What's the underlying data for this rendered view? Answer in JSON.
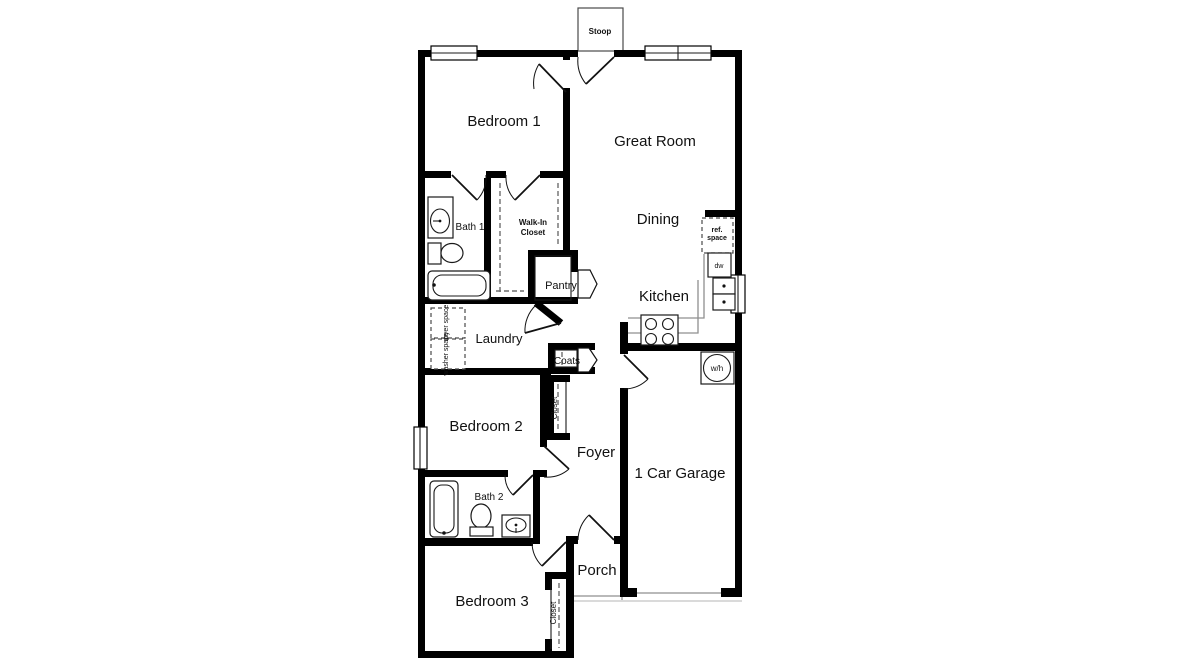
{
  "colors": {
    "wall": "#000000",
    "thin_line": "#8f8f8f",
    "background": "#ffffff",
    "text": "#111111"
  },
  "labels": {
    "stoop": "Stoop",
    "bedroom1": "Bedroom 1",
    "great_room": "Great Room",
    "dining": "Dining",
    "kitchen": "Kitchen",
    "bath1": "Bath 1",
    "walk_in_line1": "Walk-In",
    "walk_in_line2": "Closet",
    "pantry": "Pantry",
    "laundry": "Laundry",
    "coats": "Coats",
    "hall_closet": "Closet",
    "bedroom2": "Bedroom 2",
    "foyer": "Foyer",
    "bath2": "Bath 2",
    "garage": "1 Car Garage",
    "porch": "Porch",
    "bedroom3": "Bedroom 3",
    "bedroom3_closet": "Closet",
    "water_heater": "w/h",
    "dishwasher": "dw",
    "ref_line1": "ref.",
    "ref_line2": "space",
    "dryer_space": "dryer space",
    "washer_space": "washer space"
  }
}
